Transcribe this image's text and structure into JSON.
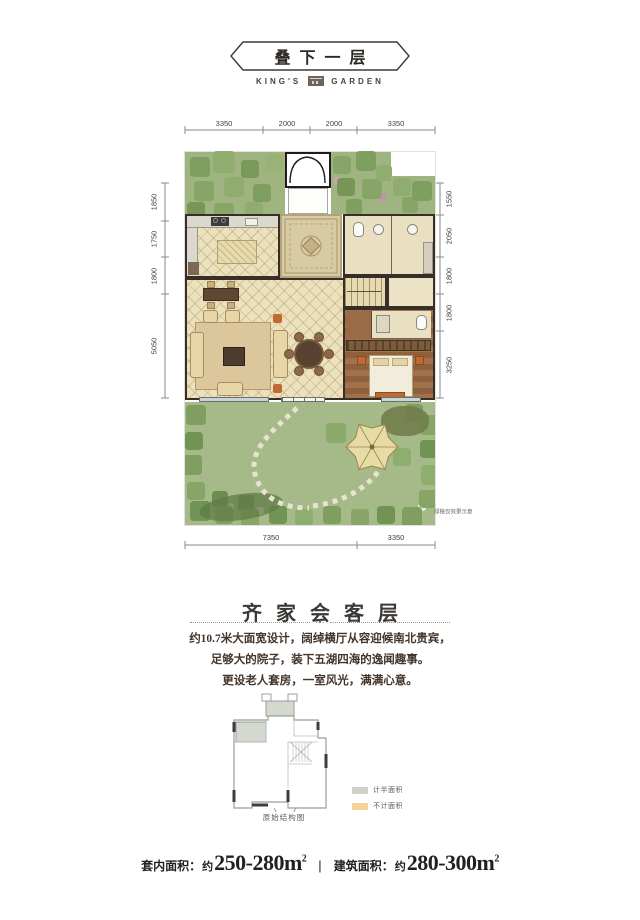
{
  "header": {
    "title": "叠下一层",
    "brand_left": "KING'S",
    "brand_right": "GARDEN"
  },
  "plan": {
    "dims_top": [
      "3350",
      "2000",
      "2000",
      "3350"
    ],
    "dims_left": [
      "1850",
      "1750",
      "1800",
      "5050"
    ],
    "dims_right": [
      "1550",
      "2050",
      "1800",
      "1800",
      "3250"
    ],
    "dims_bottom": [
      "7350",
      "3350"
    ],
    "note": "绿植仅效果示意"
  },
  "section": {
    "title": "齐家会客层",
    "ornament": "·•·",
    "lines": [
      "约10.7米大面宽设计，阔绰横厅从容迎候南北贵宾，",
      "足够大的院子，装下五湖四海的逸闻趣事。",
      "更设老人套房，一室风光，满满心意。"
    ]
  },
  "diagram": {
    "legend": [
      {
        "label": "计半面积",
        "color": "#ccd2c6"
      },
      {
        "label": "不计面积",
        "color": "#f2d49b"
      }
    ],
    "caption": "原始结构图"
  },
  "footer": {
    "label1": "套内面积：",
    "about1": "约",
    "value1": "250-280m",
    "sup1": "2",
    "sep": "|",
    "label2": "建筑面积：",
    "about2": "约",
    "value2": "280-300m",
    "sup2": "2"
  }
}
